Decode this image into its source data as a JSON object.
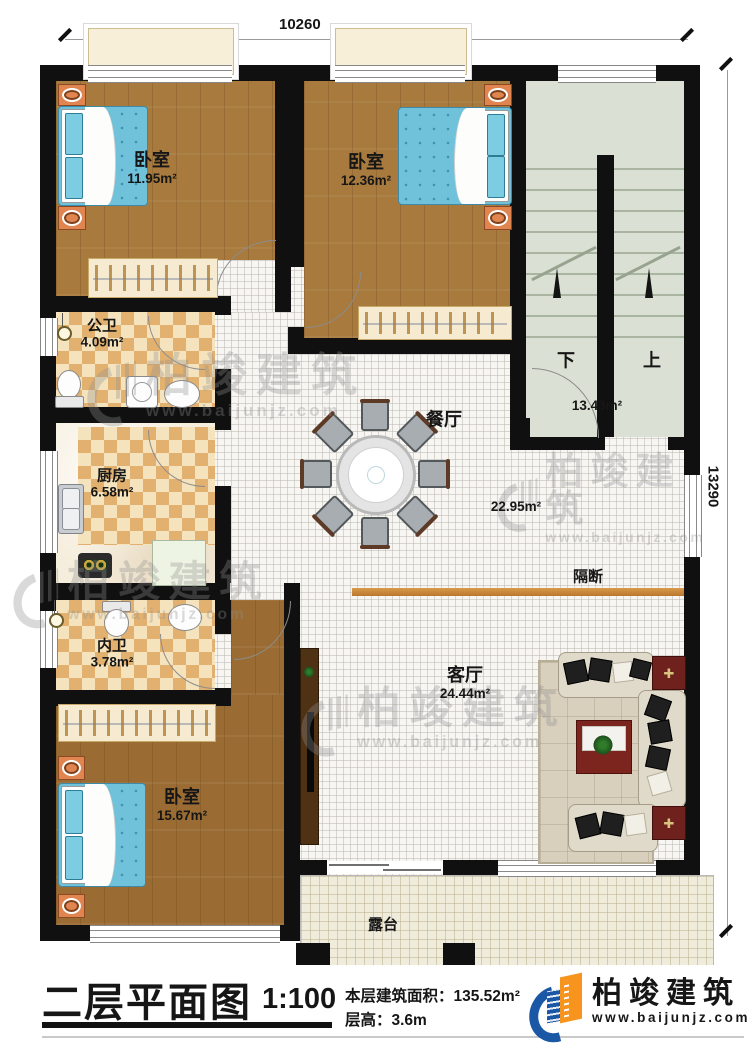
{
  "dimensions": {
    "top": "10260",
    "right": "13290"
  },
  "watermark": {
    "text": "柏竣建筑",
    "url": "www.baijunjz.com"
  },
  "rooms": {
    "bedroom_top_left": {
      "name": "卧室",
      "area": "11.95m²"
    },
    "bedroom_top_mid": {
      "name": "卧室",
      "area": "12.36m²"
    },
    "public_bath": {
      "name": "公卫",
      "area": "4.09m²"
    },
    "kitchen": {
      "name": "厨房",
      "area": "6.58m²"
    },
    "ensuite_bath": {
      "name": "内卫",
      "area": "3.78m²"
    },
    "bedroom_bottom": {
      "name": "卧室",
      "area": "15.67m²"
    },
    "dining": {
      "name": "餐厅",
      "area": "22.95m²"
    },
    "living": {
      "name": "客厅",
      "area": "24.44m²"
    },
    "stair_hall": {
      "area": "13.43m²"
    },
    "terrace": {
      "name": "露台"
    },
    "partition": {
      "name": "隔断"
    },
    "stairs": {
      "down": "下",
      "up": "上"
    }
  },
  "title_block": {
    "title": "二层平面图",
    "scale": "1:100",
    "area_line": "本层建筑面积：135.52m²",
    "height_line": "层高：3.6m"
  },
  "brand": {
    "name": "柏竣建筑",
    "url": "www.baijunjz.com"
  }
}
